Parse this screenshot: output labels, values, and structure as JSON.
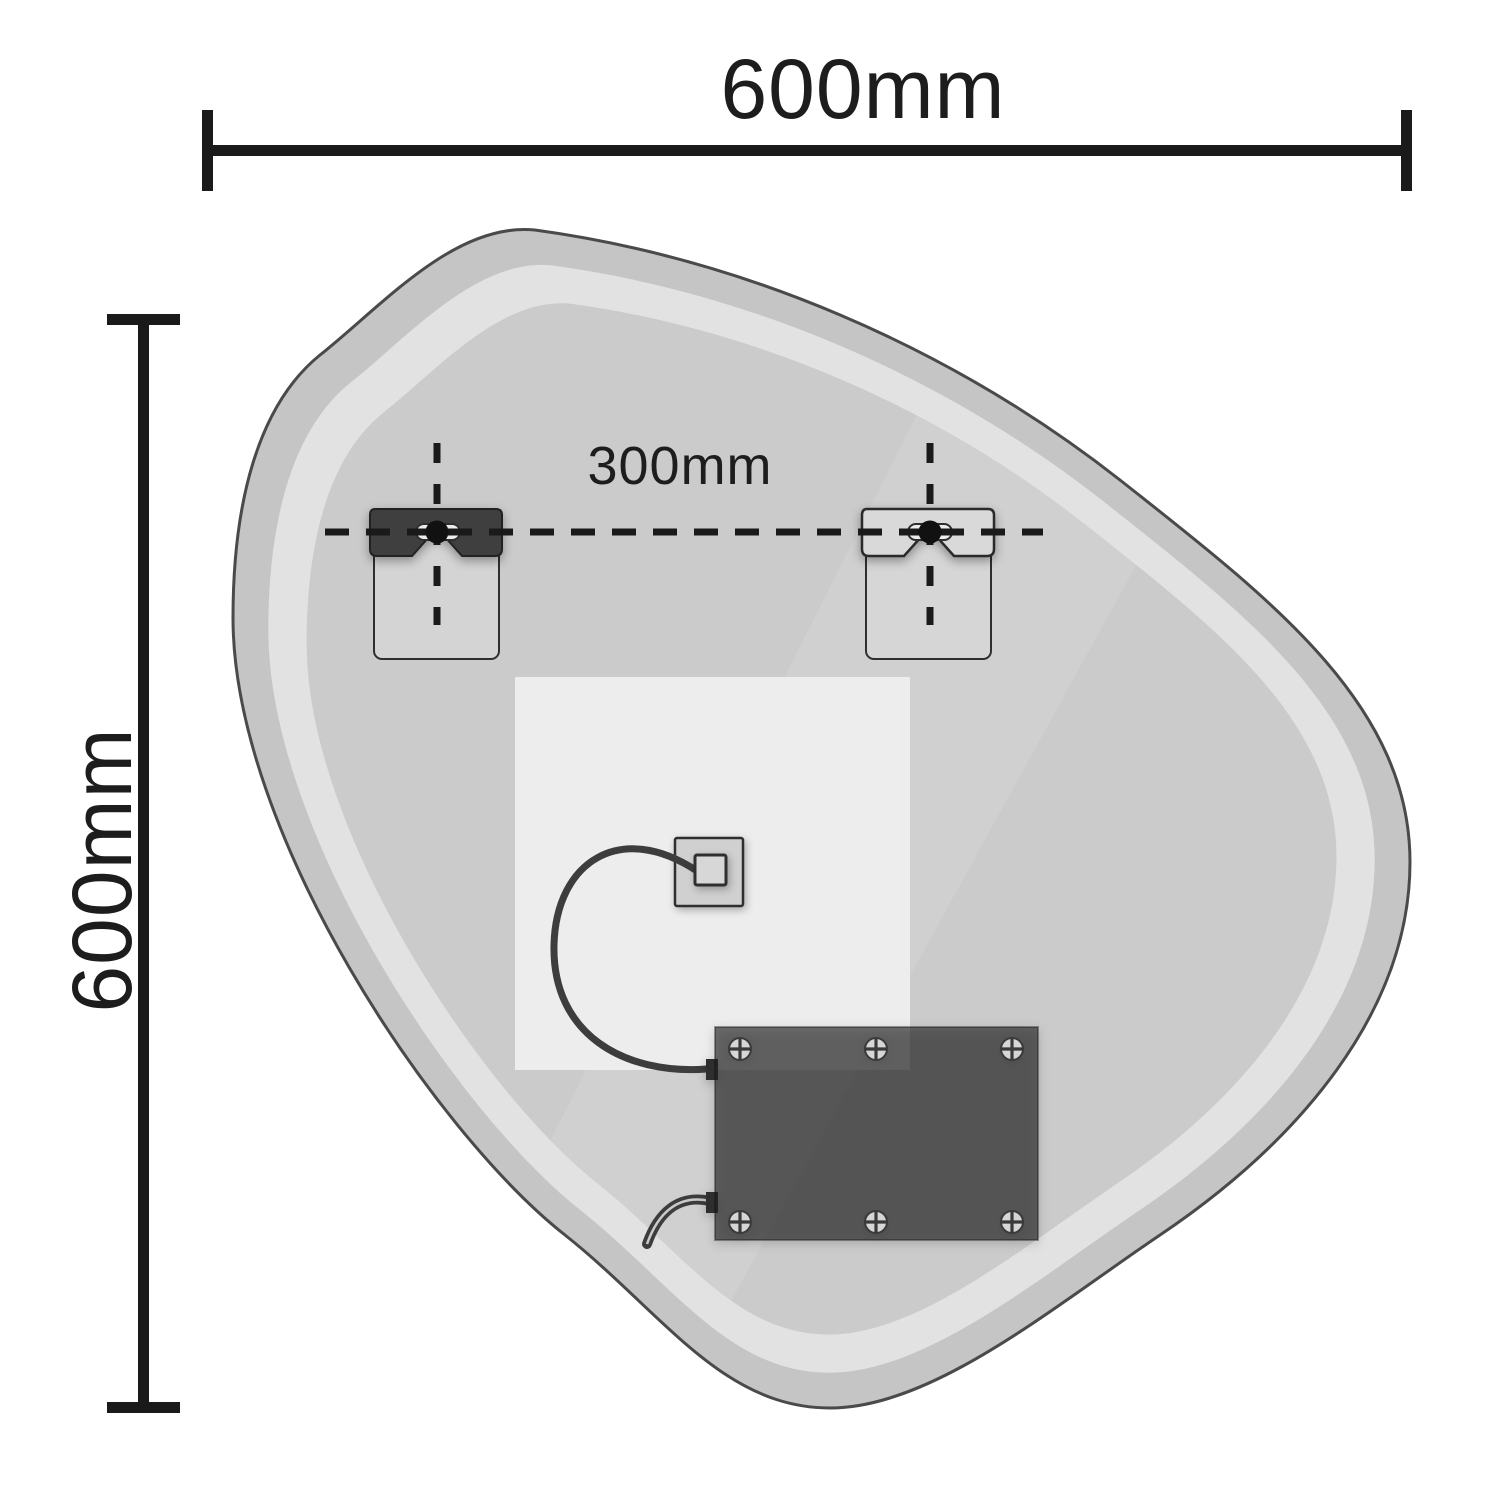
{
  "labels": {
    "overall_width": "600mm",
    "overall_height": "600mm",
    "fixing_centres": "300mm"
  },
  "colors": {
    "background": "#ffffff",
    "dimension_lines": "#1a1a1a",
    "mirror_outline": "#4a4a4a",
    "mirror_edge": "#c5c5c5",
    "mirror_highlight_ring": "#e2e2e2",
    "mirror_body": "#cbcbcb",
    "backing_panel": "#ededed",
    "bracket_plate": "#d4d4d4",
    "bracket_cleat_dark": "#3f3f3f",
    "bracket_cleat_light": "#d9d9d9",
    "keyhole_slot": "#ededed",
    "fixing_hole": "#111111",
    "driver_box": "#1e1e1e",
    "screw_head": "#d6d6d6",
    "cable": "#3d3d3d"
  }
}
